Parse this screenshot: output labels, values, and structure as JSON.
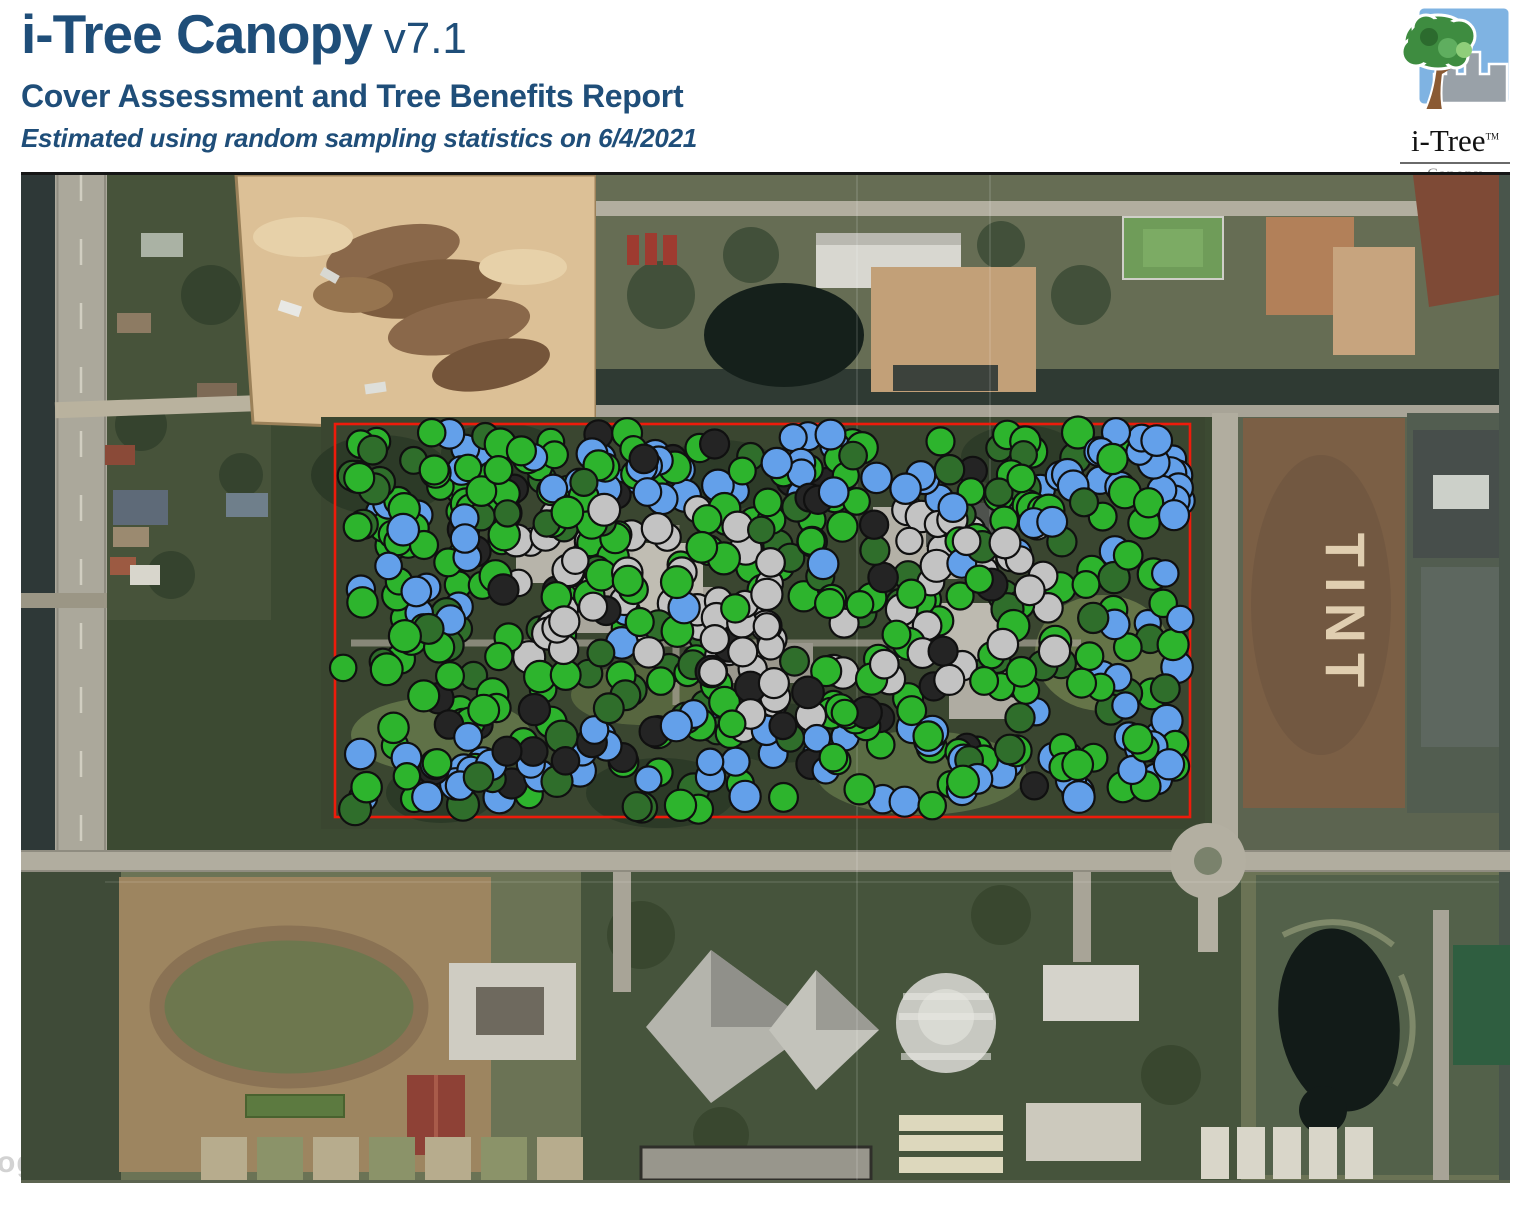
{
  "header": {
    "title": "i-Tree Canopy",
    "version": "v7.1",
    "subtitle": "Cover Assessment and Tree Benefits Report",
    "note": "Estimated using random sampling statistics on 6/4/2021",
    "text_color": "#1f4e79"
  },
  "logo": {
    "brand": "i-Tree",
    "tm": "TM",
    "product": "Canopy"
  },
  "map": {
    "tint_ground_label": "TINT",
    "watermark_fragment": "og",
    "boundary": {
      "x": 314,
      "y": 249,
      "width": 855,
      "height": 393,
      "color": "#ee1b0b",
      "stroke_width": 2.6
    },
    "sample_points": {
      "seed": 20210604,
      "dot_radius_min": 13,
      "dot_radius_max": 16,
      "outline_color": "#101010",
      "outline_width": 2.2,
      "colors": {
        "green": "#2db42d",
        "dark_green": "#2f6e2b",
        "blue": "#63a0ea",
        "gray": "#c3c3c3",
        "black": "#242424"
      },
      "regions": [
        {
          "color": "green",
          "count": 225,
          "x0": 320,
          "y0": 256,
          "x1": 1162,
          "y1": 636
        },
        {
          "color": "green",
          "count": 30,
          "x0": 322,
          "y0": 258,
          "x1": 640,
          "y1": 430
        },
        {
          "color": "dark_green",
          "count": 85,
          "x0": 320,
          "y0": 256,
          "x1": 1162,
          "y1": 636
        },
        {
          "color": "blue",
          "count": 48,
          "x0": 420,
          "y0": 256,
          "x1": 1150,
          "y1": 324
        },
        {
          "color": "blue",
          "count": 26,
          "x0": 1076,
          "y0": 262,
          "x1": 1160,
          "y1": 632
        },
        {
          "color": "blue",
          "count": 52,
          "x0": 325,
          "y0": 550,
          "x1": 1145,
          "y1": 634
        },
        {
          "color": "blue",
          "count": 14,
          "x0": 330,
          "y0": 328,
          "x1": 455,
          "y1": 455
        },
        {
          "color": "blue",
          "count": 12,
          "x0": 600,
          "y0": 330,
          "x1": 1060,
          "y1": 555
        },
        {
          "color": "gray",
          "count": 40,
          "x0": 478,
          "y0": 328,
          "x1": 762,
          "y1": 484
        },
        {
          "color": "gray",
          "count": 26,
          "x0": 856,
          "y0": 328,
          "x1": 1062,
          "y1": 518
        },
        {
          "color": "gray",
          "count": 22,
          "x0": 640,
          "y0": 428,
          "x1": 900,
          "y1": 562
        },
        {
          "color": "black",
          "count": 42,
          "x0": 380,
          "y0": 288,
          "x1": 1020,
          "y1": 618
        },
        {
          "color": "black",
          "count": 4,
          "x0": 555,
          "y0": 252,
          "x1": 700,
          "y1": 290
        }
      ]
    }
  }
}
